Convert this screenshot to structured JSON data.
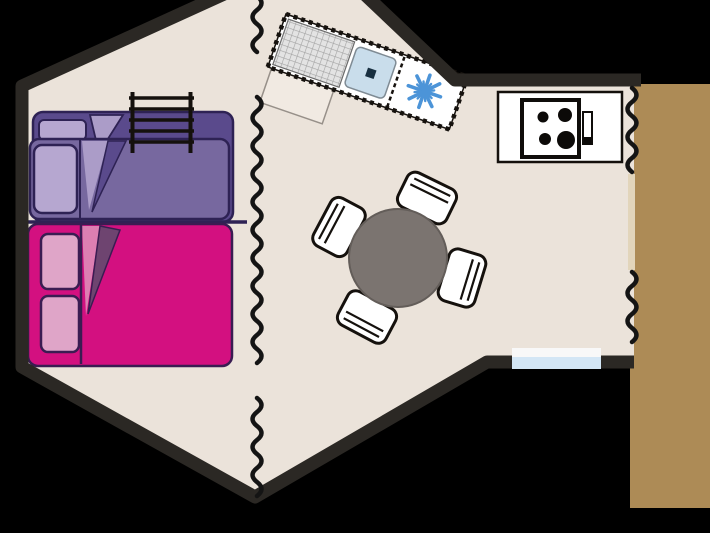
{
  "plan": {
    "kind": "campsite-tent-floor-plan",
    "areas": [
      {
        "name": "sleeping-area",
        "items": [
          "bunk-bed",
          "double-bed",
          "bunk-ladder"
        ]
      },
      {
        "name": "living-area",
        "items": [
          "dining-table",
          "chair",
          "chair",
          "chair",
          "chair"
        ]
      },
      {
        "name": "kitchen-area",
        "items": [
          "sink-unit",
          "drainboard",
          "sink",
          "fridge-snowflake",
          "stove-4-burners"
        ]
      },
      {
        "name": "exterior",
        "items": [
          "wooden-deck",
          "window",
          "canvas-entrance"
        ]
      }
    ],
    "counts": {
      "chairs": 4,
      "stove_burners": 4,
      "double_bed_pillows": 2,
      "bunk_bed_pillows": 2
    }
  },
  "colors": {
    "background": "#000000",
    "wall": "#2B2824",
    "floor": "#EBE3DA",
    "deck": "#AD8B56",
    "threshold": "#E2D5BB",
    "partition": "#141414",
    "bed_outline": "#2E2254",
    "bunk_base": "#5A4A8C",
    "bunk_blanket": "#77689F",
    "bunk_sheet": "#AB9CC8",
    "bunk_pillow": "#B6A7D0",
    "double_bed": "#D31080",
    "double_sheet": "#DC7FB2",
    "double_fold": "#6E4470",
    "double_pillow": "#DFA5C8",
    "double_outline": "#3A1C52",
    "table": "#7B7470",
    "chair": "#FFFFFF",
    "outline": "#15110D",
    "sink": "#C9DDEB",
    "drain": "#182F40",
    "snowflake": "#4C94D8",
    "window": "#D3E6F5",
    "appliance": "#FFFFFF",
    "burner": "#0C0A08",
    "drainboard": "#E3E3E3"
  }
}
